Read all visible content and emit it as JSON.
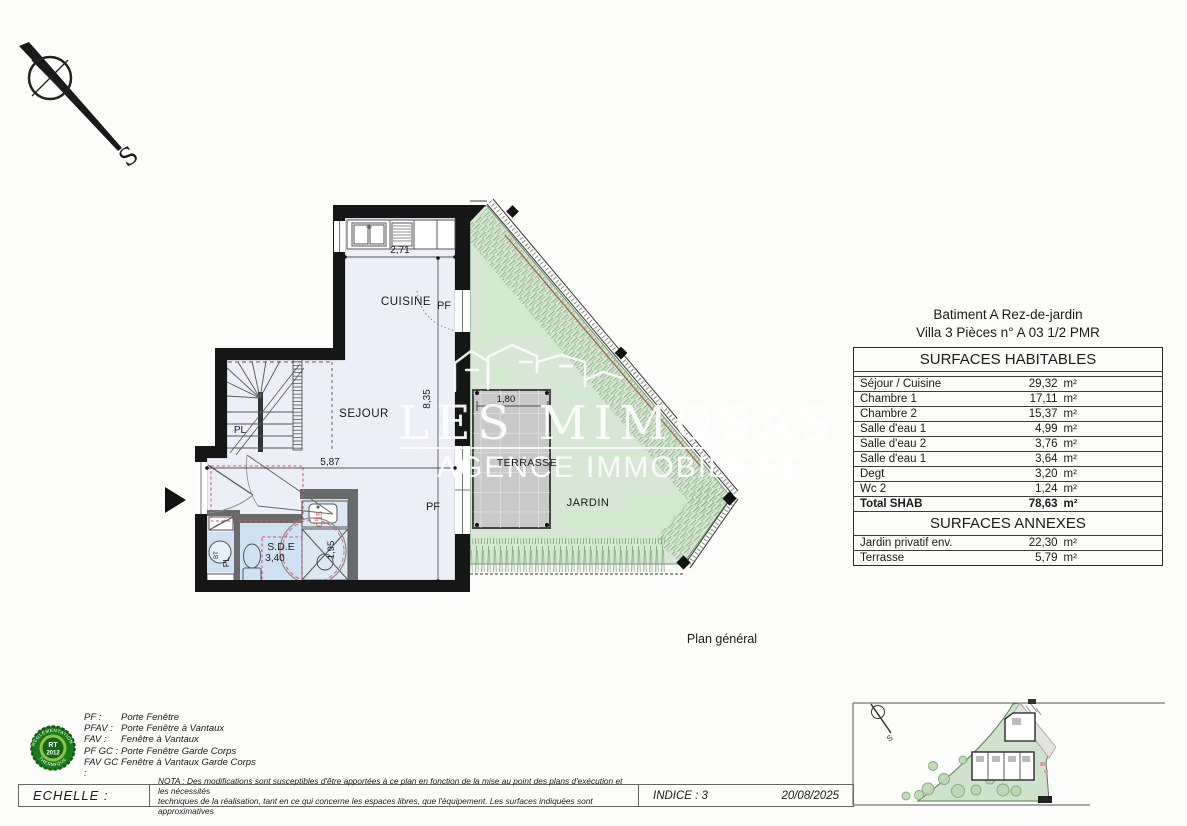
{
  "compass": {
    "south_label": "S"
  },
  "watermark": {
    "title": "LES MIMOSAS",
    "subtitle": "AGENCE IMMOBILIERE"
  },
  "plan": {
    "labels": {
      "cuisine": "CUISINE",
      "pf_cuisine": "PF",
      "sejour": "SEJOUR",
      "pf_sejour": "PF",
      "placard_stair": "PL",
      "sde": "S.D.E",
      "bt": "BT",
      "placard_bt": "PL",
      "terrasse": "TERRASSE",
      "jardin": "JARDIN"
    },
    "dimensions": {
      "cuisine_width": "2,71",
      "sejour_depth": "8,35",
      "sejour_width": "5,87",
      "terrasse_width": "1,80",
      "sde_area": "3,40",
      "sde_width": "1,95",
      "offset": "0,15"
    }
  },
  "caption": "Plan général",
  "surfaces": {
    "title_line1": "Batiment A Rez-de-jardin",
    "title_line2": "Villa 3 Pièces n° A 03 1/2 PMR",
    "header_habitables": "SURFACES HABITABLES",
    "rows": [
      {
        "label": "Séjour / Cuisine",
        "value": "29,32",
        "unit": "m²"
      },
      {
        "label": "Chambre 1",
        "value": "17,11",
        "unit": "m²"
      },
      {
        "label": "Chambre 2",
        "value": "15,37",
        "unit": "m²"
      },
      {
        "label": "Salle d'eau 1",
        "value": "4,99",
        "unit": "m²"
      },
      {
        "label": "Salle d'eau 2",
        "value": "3,76",
        "unit": "m²"
      },
      {
        "label": "Salle d'eau 1",
        "value": "3,64",
        "unit": "m²"
      },
      {
        "label": "Degt",
        "value": "3,20",
        "unit": "m²"
      },
      {
        "label": "Wc 2",
        "value": "1,24",
        "unit": "m²"
      }
    ],
    "total": {
      "label": "Total SHAB",
      "value": "78,63",
      "unit": "m²"
    },
    "header_annexes": "SURFACES ANNEXES",
    "annexes": [
      {
        "label": "Jardin privatif env.",
        "value": "22,30",
        "unit": "m²"
      },
      {
        "label": "Terrasse",
        "value": "5,79",
        "unit": "m²"
      }
    ]
  },
  "legend": {
    "entries": [
      {
        "abbr": "PF :",
        "label": "Porte Fenêtre"
      },
      {
        "abbr": "PFAV :",
        "label": "Porte Fenêtre à Vantaux"
      },
      {
        "abbr": "FAV :",
        "label": "Fenêtre à Vantaux"
      },
      {
        "abbr": "PF GC :",
        "label": "Porte Fenêtre Garde Corps"
      },
      {
        "abbr": "FAV GC :",
        "label": "Fenêtre à Vantaux Garde Corps"
      }
    ]
  },
  "rt_badge": {
    "top": "RÉGLEMENTATION",
    "line1": "RT",
    "line2": "2012",
    "bottom": "THERMIQUE"
  },
  "footer": {
    "scale_label": "ECHELLE :",
    "nota_line1": "NOTA : Des modifications sont susceptibles d'être apportées à ce plan en fonction de la mise au point des plans d'exécution et les nécessités",
    "nota_line2": "techniques de la réalisation, tant en ce qui concerne les espaces libres, que l'équipement. Les surfaces indiquées sont approximatives",
    "indice": "INDICE : 3",
    "date": "20/08/2025"
  },
  "site_map": {
    "south_label": "S"
  },
  "colors": {
    "wall": "#161616",
    "floor": "#edeff8",
    "wet_floor": "#cfe2f1",
    "garden": "#d6e7d4",
    "hedge": "#7da877",
    "terrace": "#c9c9c9",
    "pmr_red": "#d84f5f",
    "rt_green": "#1c7a1c"
  }
}
